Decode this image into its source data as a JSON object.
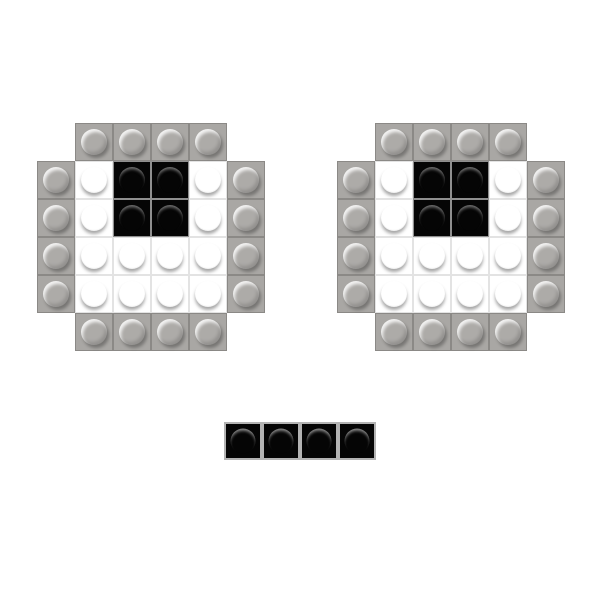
{
  "palette": {
    "page_bg": "#ffffff",
    "gray": "#a9a7a4",
    "gray_border": "#8b8986",
    "gray_stud": "#adaba8",
    "white": "#ffffff",
    "white_border": "#e3e3e3",
    "black": "#050505",
    "black_border": "#8f8f8f",
    "mouth_border": "#b3b3b3"
  },
  "bricks": {
    "cell_types": {
      "G": "gray",
      "W": "white",
      "B": "black",
      ".": "empty"
    },
    "tile_size_px": 38,
    "grids": {
      "left_eye": {
        "rows": [
          ".GGGG.",
          "GWBBWG",
          "GWBBWG",
          "GWWWWG",
          "GWWWWG",
          ".GGGG."
        ]
      },
      "right_eye": {
        "rows": [
          ".GGGG.",
          "GWBBWG",
          "GWBBWG",
          "GWWWWG",
          "GWWWWG",
          ".GGGG."
        ]
      },
      "mouth": {
        "rows": [
          "BBBB"
        ]
      }
    }
  }
}
